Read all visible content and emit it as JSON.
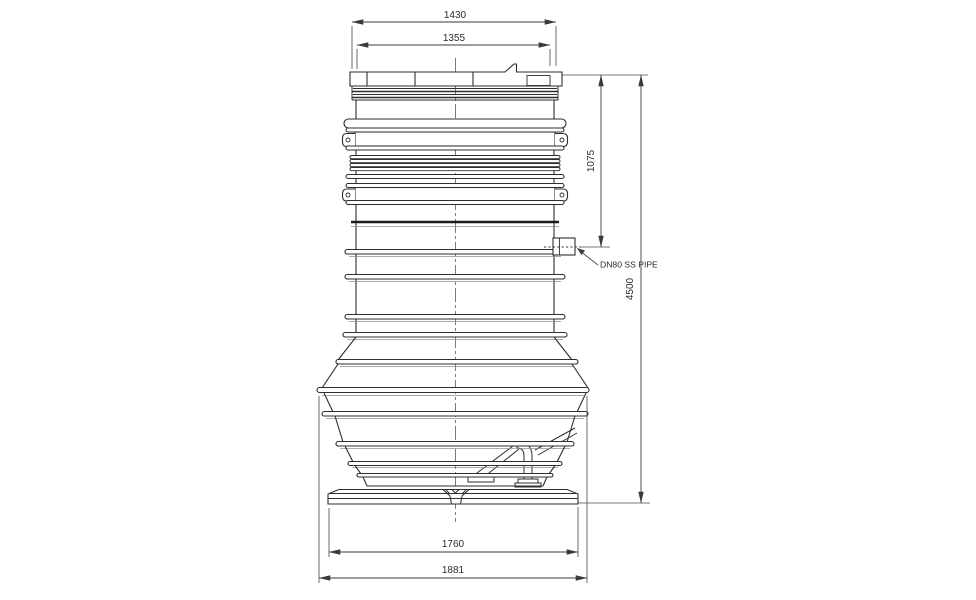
{
  "drawing": {
    "dims": {
      "lid_outer_width": "1430",
      "lid_inner_width": "1355",
      "inlet_drop_height": "1075",
      "overall_height": "4500",
      "base_plate_width": "1760",
      "overall_width": "1881"
    },
    "callouts": {
      "inlet_pipe": "DN80 SS PIPE"
    },
    "colors": {
      "background": "#ffffff",
      "line": "#2e2e2e",
      "line_light": "#8f8f8f",
      "dim_line": "#4a4a4a"
    }
  }
}
